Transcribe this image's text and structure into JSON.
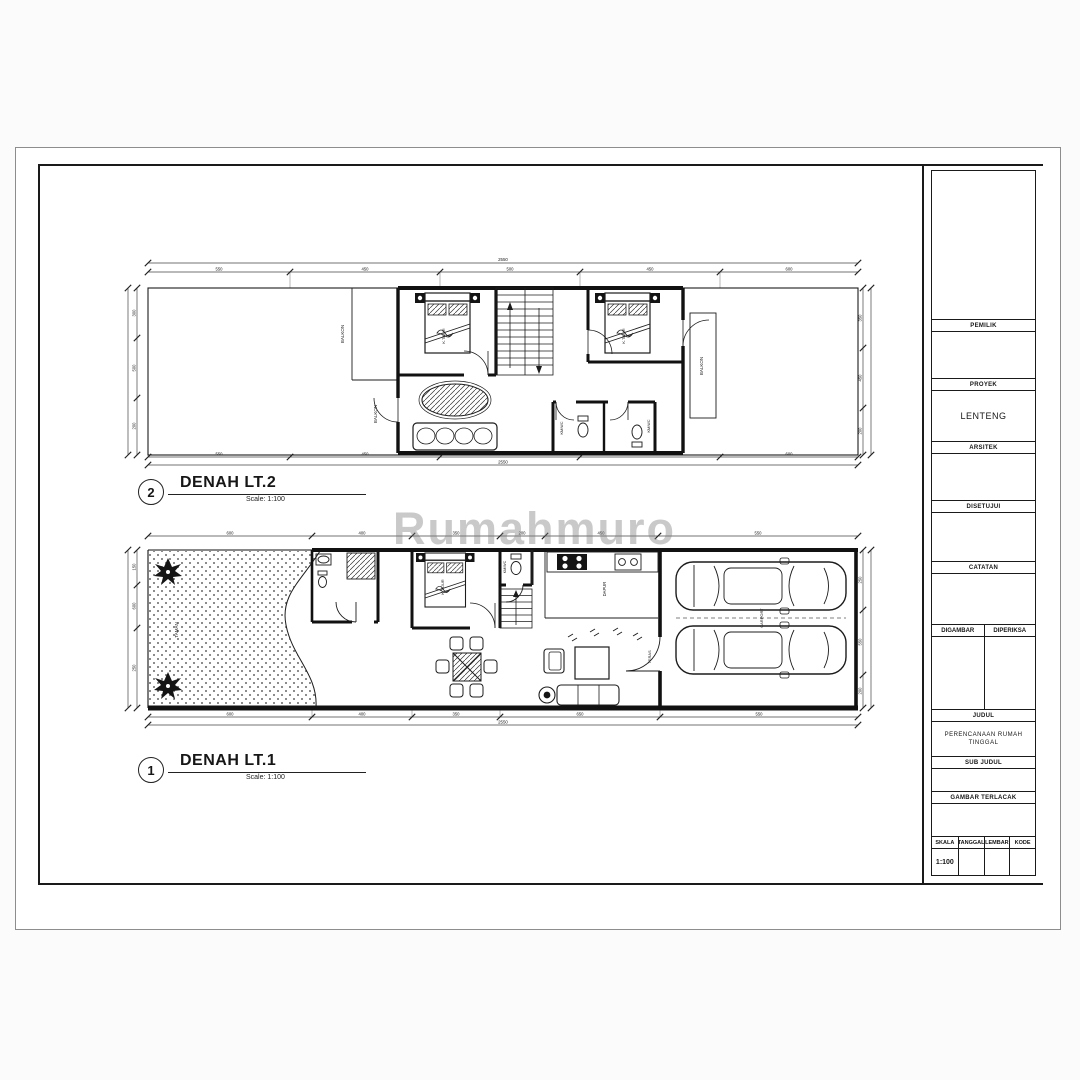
{
  "page": {
    "background": "#fbfbfb",
    "paper": "#ffffff",
    "line_color": "#1a1a1a"
  },
  "watermark": {
    "text": "Rumahmuro"
  },
  "captions": {
    "floor2": {
      "number": "2",
      "title": "DENAH LT.2",
      "scale": "Scale: 1:100"
    },
    "floor1": {
      "number": "1",
      "title": "DENAH LT.1",
      "scale": "Scale: 1:100"
    }
  },
  "floor2_labels": {
    "balkon_a": "BALKON",
    "balkon_b": "BALKON",
    "balkon_c": "BALKON",
    "bed_a": "K.TIDUR",
    "bed_b": "K.TIDUR",
    "wc_a": "KM/WC",
    "wc_b": "KM/WC"
  },
  "floor1_labels": {
    "taman": "TAMAN",
    "bed": "K.TIDUR",
    "wc": "KM/WC",
    "dapur": "DAPUR",
    "teras": "TERAS",
    "carport": "CARPORT"
  },
  "dims": {
    "f2_top_total": "2550",
    "f2_top": [
      "550",
      "450",
      "500",
      "450",
      "600"
    ],
    "f2_bottom": [
      "550",
      "450",
      "500",
      "450",
      "600"
    ],
    "f2_bottom_total": "2550",
    "f2_left": [
      "300",
      "500",
      "200"
    ],
    "f2_right": [
      "350",
      "450",
      "200"
    ],
    "f1_top": [
      "600",
      "400",
      "350",
      "200",
      "450",
      "550"
    ],
    "f1_bottom": [
      "600",
      "400",
      "350",
      "650",
      "550"
    ],
    "f1_bottom_total": "2550",
    "f1_left": [
      "150",
      "600",
      "250"
    ],
    "f1_right": [
      "250",
      "550",
      "200"
    ]
  },
  "title_block": {
    "owner_label": "PEMILIK",
    "project_label": "PROYEK",
    "project_value": "LENTENG",
    "architect_label": "ARSITEK",
    "approved_label": "DISETUJUI",
    "notes_label": "CATATAN",
    "drawn_label": "DIGAMBAR",
    "checked_label": "DIPERIKSA",
    "title_label": "JUDUL",
    "title_value": "PERENCANAAN RUMAH TINGGAL",
    "subtitle_label": "SUB JUDUL",
    "traced_label": "GAMBAR TERLACAK",
    "scale_label": "SKALA",
    "scale_value": "1:100",
    "date_label": "TANGGAL",
    "sheet_label": "LEMBAR",
    "code_label": "KODE"
  }
}
